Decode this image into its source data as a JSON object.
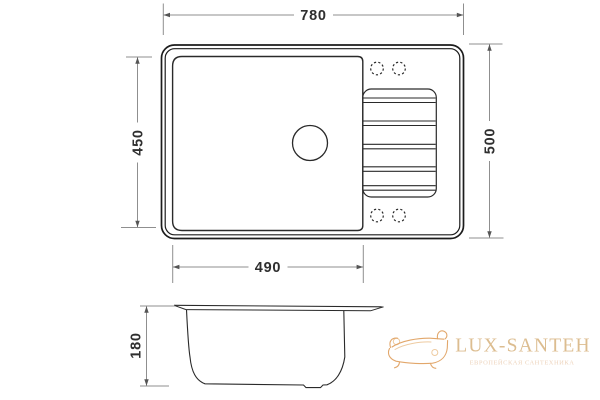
{
  "colors": {
    "background": "#ffffff",
    "outline": "#1c1c1c",
    "dimension_line": "#8f8f8f",
    "dimension_text": "#2f2f2f",
    "watermark_brand": "#dcbd90",
    "watermark_tagline": "#edd3bb",
    "watermark_icon": "#e2a76b"
  },
  "top_view": {
    "dim_overall_width": "780",
    "dim_overall_depth": "500",
    "dim_bowl_width": "490",
    "dim_bowl_depth": "450"
  },
  "section_view": {
    "dim_bowl_height": "180"
  },
  "watermark": {
    "brand": "LUX-SANTEH",
    "tagline": "ЕВРОПЕЙСКАЯ САНТЕХНИКА"
  }
}
